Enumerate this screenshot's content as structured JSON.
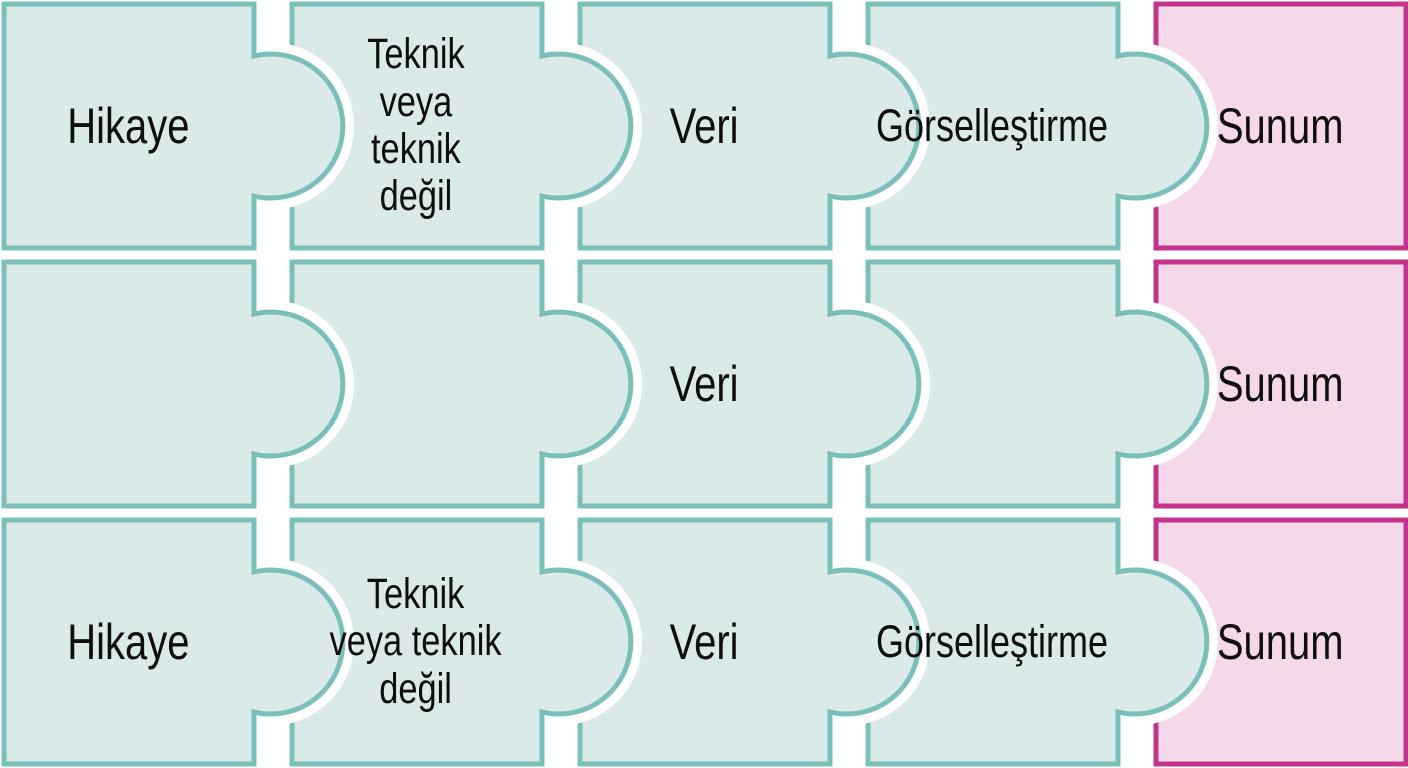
{
  "diagram": {
    "type": "puzzle-process-diagram",
    "language": "tr",
    "colors": {
      "background": "#ffffff",
      "piece_fill_teal": "#d9eae8",
      "piece_border_teal": "#7bbfbb",
      "piece_fill_pink": "#f5d8ea",
      "piece_border_pink": "#c2348b",
      "label_text": "#0e0e0e"
    },
    "rows": [
      {
        "pieces": [
          {
            "label": "Hikaye",
            "color": "teal"
          },
          {
            "label": "Teknik\nveya\nteknik\ndeğil",
            "color": "teal"
          },
          {
            "label": "Veri",
            "color": "teal"
          },
          {
            "label": "Görselleştirme",
            "color": "teal"
          },
          {
            "label": "Sunum",
            "color": "pink"
          }
        ]
      },
      {
        "pieces": [
          {
            "label": "",
            "color": "teal"
          },
          {
            "label": "",
            "color": "teal"
          },
          {
            "label": "Veri",
            "color": "teal"
          },
          {
            "label": "",
            "color": "teal"
          },
          {
            "label": "Sunum",
            "color": "pink"
          }
        ]
      },
      {
        "pieces": [
          {
            "label": "Hikaye",
            "color": "teal"
          },
          {
            "label": "Teknik\nveya teknik\ndeğil",
            "color": "teal"
          },
          {
            "label": "Veri",
            "color": "teal"
          },
          {
            "label": "Görselleştirme",
            "color": "teal"
          },
          {
            "label": "Sunum",
            "color": "pink"
          }
        ]
      }
    ]
  }
}
